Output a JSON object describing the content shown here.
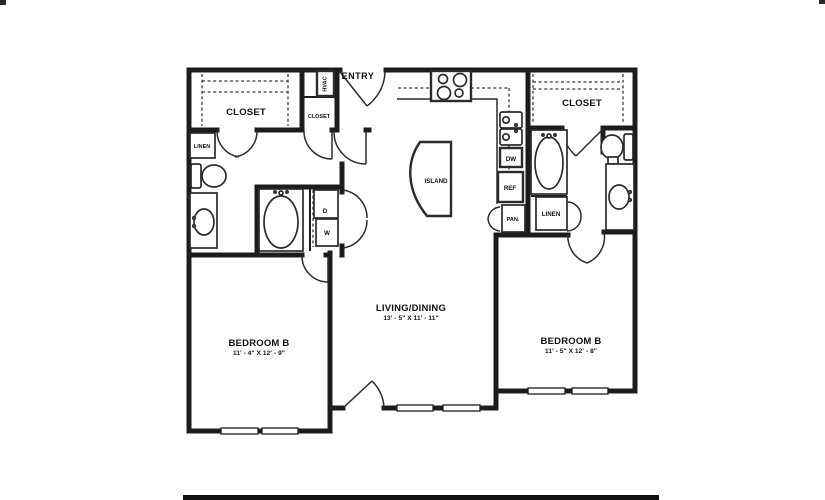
{
  "labels": {
    "entry": "ENTRY",
    "closet_left": "CLOSET",
    "closet_hall": "CLOSET",
    "closet_right": "CLOSET",
    "hvac": "HVAC",
    "linen_left": "LINEN",
    "linen_right": "LINEN",
    "island": "ISLAND",
    "dishwasher": "DW",
    "refrigerator": "REF",
    "pantry": "PAN.",
    "dryer": "D",
    "washer": "W",
    "living_dining": {
      "name": "LIVING/DINING",
      "dims": "13' - 5\" X 11' - 11\""
    },
    "bedroom_left": {
      "name": "BEDROOM B",
      "dims": "11' - 4\" X 12' - 9\""
    },
    "bedroom_right": {
      "name": "BEDROOM B",
      "dims": "11' - 5\" X 12' - 8\""
    }
  }
}
